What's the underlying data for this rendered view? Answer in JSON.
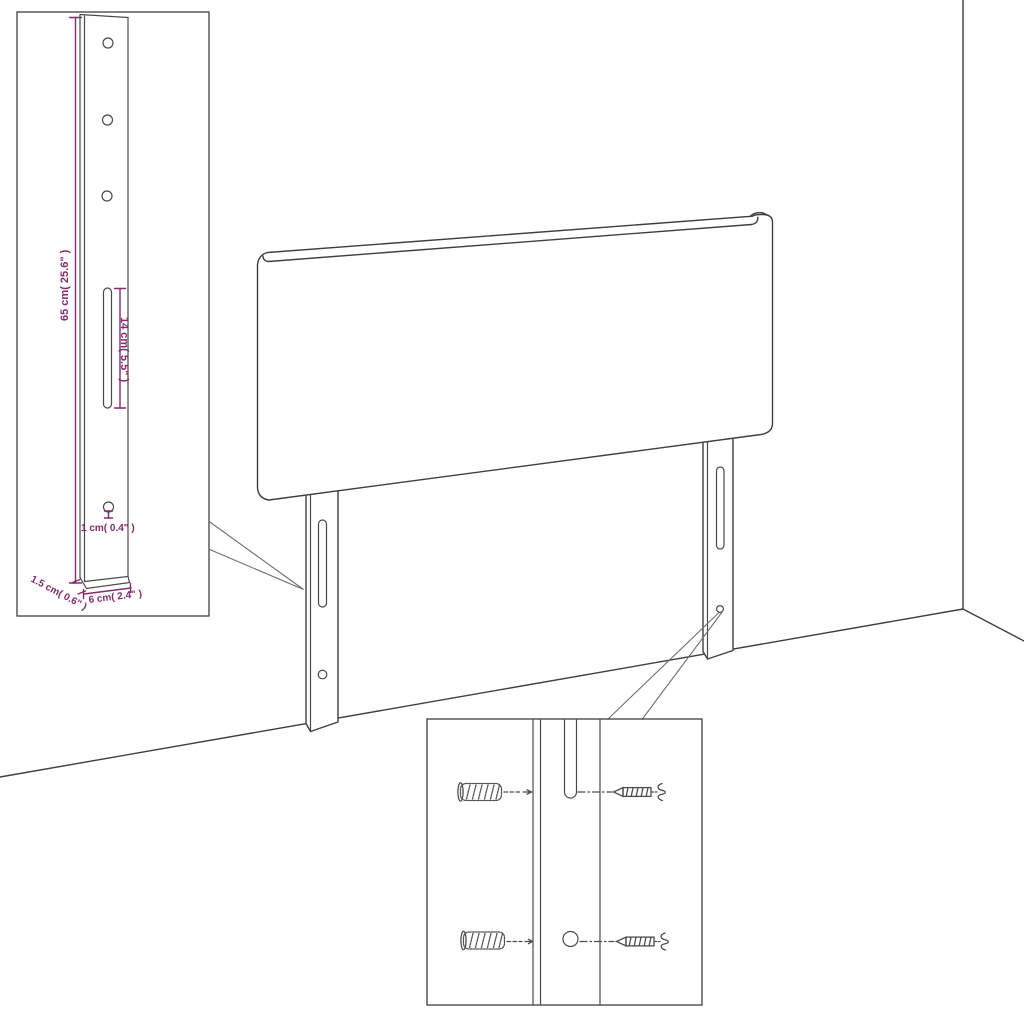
{
  "diagram": {
    "type": "furniture-assembly-diagram",
    "subject": "headboard with mounting legs against wall corner",
    "colors": {
      "outline": "#3f3f3f",
      "dimension_accent": "#832c6d",
      "background": "#ffffff"
    },
    "bracket_detail": {
      "labels": {
        "height": "65 cm( 25.6\" )",
        "slot_length": "14 cm( 5.5\" )",
        "hole_diameter": "1 cm( 0.4\" )",
        "thickness": "1.5 cm( 0.6\" )",
        "width": "6 cm( 2.4\" )"
      },
      "hole_count": 4,
      "slot_count": 1
    },
    "hardware_detail": {
      "icons": [
        "wall-plug-icon",
        "screw-icon"
      ],
      "rows": 2
    }
  }
}
